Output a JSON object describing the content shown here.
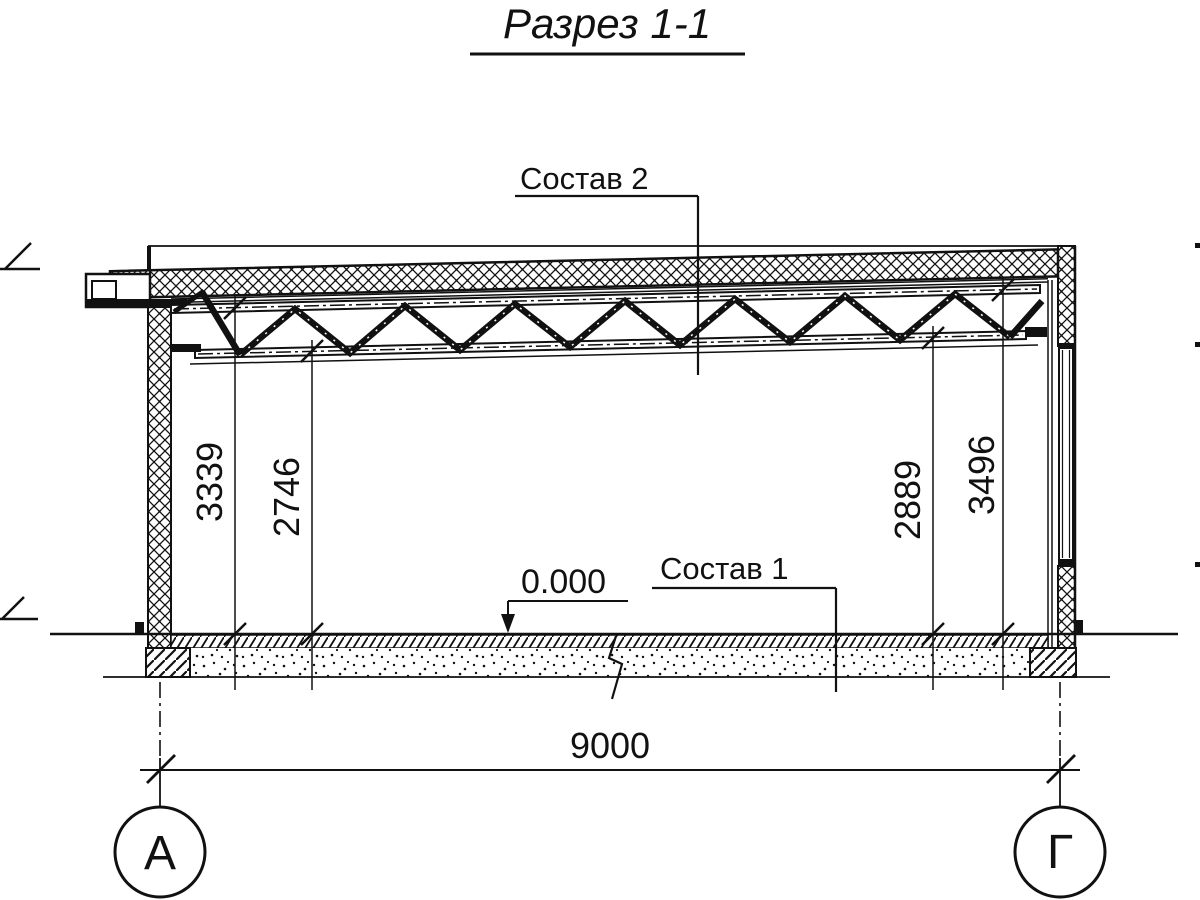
{
  "title": "Разрез 1-1",
  "callouts": {
    "roof_composition": "Состав 2",
    "floor_composition": "Состав 1",
    "floor_level": "0.000"
  },
  "dimensions": {
    "roof_height_left": "3339",
    "truss_bottom_left": "2746",
    "truss_bottom_right": "2889",
    "roof_height_right": "3496",
    "span": "9000"
  },
  "grid_axes": {
    "left": "А",
    "right": "Г"
  },
  "colors": {
    "ink": "#111111",
    "paper": "#ffffff"
  }
}
